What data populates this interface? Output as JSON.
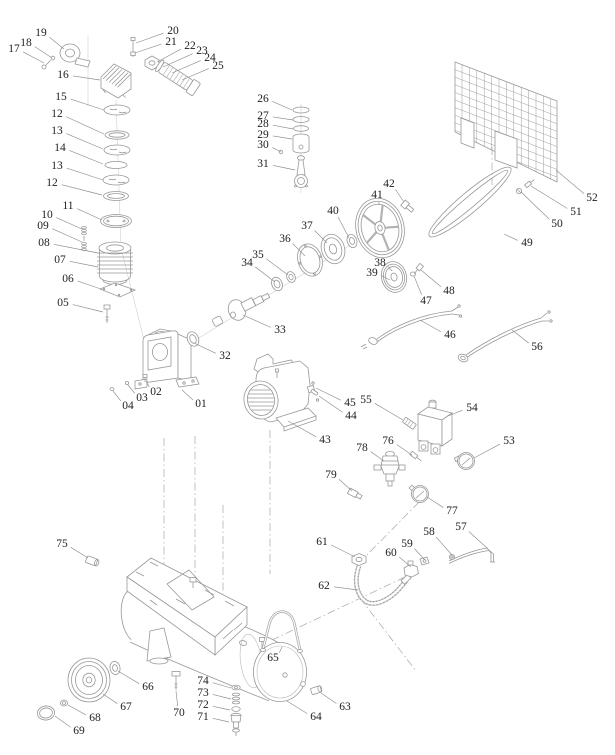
{
  "page": {
    "background": "#ffffff"
  },
  "diagram": {
    "kind": "exploded-parts-diagram",
    "line_color": "#98989c",
    "label_color": "#1e1e1e",
    "label_font_size": 11.5,
    "labels": [
      {
        "n": "17",
        "x": 14,
        "y": 49,
        "tx": 44,
        "ty": 63
      },
      {
        "n": "18",
        "x": 26,
        "y": 43,
        "tx": 52,
        "ty": 58
      },
      {
        "n": "19",
        "x": 41,
        "y": 33,
        "tx": 64,
        "ty": 49
      },
      {
        "n": "20",
        "x": 173,
        "y": 31,
        "tx": 136,
        "ty": 43
      },
      {
        "n": "21",
        "x": 171,
        "y": 42,
        "tx": 135,
        "ty": 53
      },
      {
        "n": "22",
        "x": 190,
        "y": 46,
        "tx": 157,
        "ty": 62
      },
      {
        "n": "23",
        "x": 202,
        "y": 51,
        "tx": 163,
        "ty": 67
      },
      {
        "n": "24",
        "x": 210,
        "y": 58,
        "tx": 172,
        "ty": 73
      },
      {
        "n": "25",
        "x": 218,
        "y": 66,
        "tx": 182,
        "ty": 80
      },
      {
        "n": "16",
        "x": 63,
        "y": 75,
        "tx": 100,
        "ty": 80
      },
      {
        "n": "15",
        "x": 61,
        "y": 97,
        "tx": 104,
        "ty": 110
      },
      {
        "n": "12",
        "x": 57,
        "y": 114,
        "tx": 104,
        "ty": 134
      },
      {
        "n": "13",
        "x": 57,
        "y": 131,
        "tx": 103,
        "ty": 149
      },
      {
        "n": "14",
        "x": 60,
        "y": 148,
        "tx": 103,
        "ty": 164
      },
      {
        "n": "13",
        "x": 57,
        "y": 166,
        "tx": 103,
        "ty": 180
      },
      {
        "n": "12",
        "x": 52,
        "y": 183,
        "tx": 102,
        "ty": 195
      },
      {
        "n": "11",
        "x": 68,
        "y": 206,
        "tx": 102,
        "ty": 220
      },
      {
        "n": "10",
        "x": 47,
        "y": 215,
        "tx": 82,
        "ty": 229
      },
      {
        "n": "09",
        "x": 43,
        "y": 226,
        "tx": 82,
        "ty": 242
      },
      {
        "n": "08",
        "x": 44,
        "y": 243,
        "tx": 98,
        "ty": 253
      },
      {
        "n": "07",
        "x": 60,
        "y": 260,
        "tx": 98,
        "ty": 267
      },
      {
        "n": "06",
        "x": 68,
        "y": 279,
        "tx": 101,
        "ty": 289
      },
      {
        "n": "05",
        "x": 63,
        "y": 303,
        "tx": 103,
        "ty": 312
      },
      {
        "n": "26",
        "x": 263,
        "y": 99,
        "tx": 292,
        "ty": 110
      },
      {
        "n": "27",
        "x": 263,
        "y": 116,
        "tx": 293,
        "ty": 120
      },
      {
        "n": "28",
        "x": 263,
        "y": 124,
        "tx": 293,
        "ty": 129
      },
      {
        "n": "29",
        "x": 263,
        "y": 135,
        "tx": 292,
        "ty": 139
      },
      {
        "n": "30",
        "x": 263,
        "y": 145,
        "tx": 281,
        "ty": 152
      },
      {
        "n": "31",
        "x": 263,
        "y": 164,
        "tx": 295,
        "ty": 170
      },
      {
        "n": "32",
        "x": 225,
        "y": 356,
        "tx": 194,
        "ty": 343
      },
      {
        "n": "33",
        "x": 280,
        "y": 330,
        "tx": 243,
        "ty": 315
      },
      {
        "n": "34",
        "x": 247,
        "y": 263,
        "tx": 275,
        "ty": 282
      },
      {
        "n": "35",
        "x": 258,
        "y": 255,
        "tx": 288,
        "ty": 275
      },
      {
        "n": "36",
        "x": 285,
        "y": 239,
        "tx": 305,
        "ty": 256
      },
      {
        "n": "37",
        "x": 307,
        "y": 226,
        "tx": 327,
        "ty": 243
      },
      {
        "n": "38",
        "x": 380,
        "y": 263,
        "tx": 392,
        "ty": 271
      },
      {
        "n": "39",
        "x": 372,
        "y": 273,
        "tx": 390,
        "ty": 280
      },
      {
        "n": "40",
        "x": 333,
        "y": 211,
        "tx": 349,
        "ty": 238
      },
      {
        "n": "41",
        "x": 377,
        "y": 195,
        "tx": 379,
        "ty": 205
      },
      {
        "n": "42",
        "x": 389,
        "y": 184,
        "tx": 404,
        "ty": 202
      },
      {
        "n": "43",
        "x": 325,
        "y": 440,
        "tx": 288,
        "ty": 421
      },
      {
        "n": "44",
        "x": 351,
        "y": 416,
        "tx": 319,
        "ty": 396
      },
      {
        "n": "45",
        "x": 350,
        "y": 403,
        "tx": 316,
        "ty": 388
      },
      {
        "n": "46",
        "x": 450,
        "y": 335,
        "tx": 420,
        "ty": 320
      },
      {
        "n": "47",
        "x": 426,
        "y": 301,
        "tx": 414,
        "ty": 276
      },
      {
        "n": "48",
        "x": 449,
        "y": 291,
        "tx": 421,
        "ty": 270
      },
      {
        "n": "49",
        "x": 527,
        "y": 243,
        "tx": 504,
        "ty": 234
      },
      {
        "n": "50",
        "x": 557,
        "y": 224,
        "tx": 521,
        "ty": 192
      },
      {
        "n": "51",
        "x": 576,
        "y": 212,
        "tx": 531,
        "ty": 186
      },
      {
        "n": "52",
        "x": 592,
        "y": 198,
        "tx": 556,
        "ty": 170
      },
      {
        "n": "53",
        "x": 509,
        "y": 441,
        "tx": 474,
        "ty": 458
      },
      {
        "n": "54",
        "x": 472,
        "y": 408,
        "tx": 448,
        "ty": 416
      },
      {
        "n": "55",
        "x": 366,
        "y": 400,
        "tx": 403,
        "ty": 420
      },
      {
        "n": "56",
        "x": 537,
        "y": 347,
        "tx": 512,
        "ty": 330
      },
      {
        "n": "57",
        "x": 461,
        "y": 527,
        "tx": 488,
        "ty": 549
      },
      {
        "n": "58",
        "x": 429,
        "y": 532,
        "tx": 452,
        "ty": 555
      },
      {
        "n": "59",
        "x": 407,
        "y": 544,
        "tx": 425,
        "ty": 560
      },
      {
        "n": "60",
        "x": 391,
        "y": 553,
        "tx": 411,
        "ty": 567
      },
      {
        "n": "61",
        "x": 322,
        "y": 542,
        "tx": 355,
        "ty": 557
      },
      {
        "n": "62",
        "x": 324,
        "y": 586,
        "tx": 358,
        "ty": 590
      },
      {
        "n": "63",
        "x": 345,
        "y": 707,
        "tx": 321,
        "ty": 693
      },
      {
        "n": "64",
        "x": 316,
        "y": 717,
        "tx": 287,
        "ty": 701
      },
      {
        "n": "65",
        "x": 273,
        "y": 658,
        "tx": 282,
        "ty": 647
      },
      {
        "n": "66",
        "x": 148,
        "y": 687,
        "tx": 118,
        "ty": 671
      },
      {
        "n": "67",
        "x": 126,
        "y": 707,
        "tx": 103,
        "ty": 694
      },
      {
        "n": "68",
        "x": 95,
        "y": 718,
        "tx": 68,
        "ty": 705
      },
      {
        "n": "69",
        "x": 79,
        "y": 731,
        "tx": 55,
        "ty": 716
      },
      {
        "n": "70",
        "x": 179,
        "y": 713,
        "tx": 176,
        "ty": 691
      },
      {
        "n": "71",
        "x": 203,
        "y": 717,
        "tx": 229,
        "ty": 722
      },
      {
        "n": "72",
        "x": 203,
        "y": 705,
        "tx": 230,
        "ty": 710
      },
      {
        "n": "73",
        "x": 203,
        "y": 693,
        "tx": 231,
        "ty": 699
      },
      {
        "n": "74",
        "x": 203,
        "y": 681,
        "tx": 231,
        "ty": 688
      },
      {
        "n": "75",
        "x": 62,
        "y": 544,
        "tx": 88,
        "ty": 558
      },
      {
        "n": "76",
        "x": 388,
        "y": 441,
        "tx": 412,
        "ty": 455
      },
      {
        "n": "77",
        "x": 452,
        "y": 511,
        "tx": 427,
        "ty": 497
      },
      {
        "n": "78",
        "x": 362,
        "y": 448,
        "tx": 384,
        "ty": 461
      },
      {
        "n": "79",
        "x": 331,
        "y": 475,
        "tx": 352,
        "ty": 491
      },
      {
        "n": "01",
        "x": 201,
        "y": 404,
        "tx": 182,
        "ty": 390
      },
      {
        "n": "02",
        "x": 156,
        "y": 392,
        "tx": 146,
        "ty": 381
      },
      {
        "n": "03",
        "x": 142,
        "y": 398,
        "tx": 128,
        "ty": 385
      },
      {
        "n": "04",
        "x": 128,
        "y": 406,
        "tx": 113,
        "ty": 391
      }
    ]
  }
}
